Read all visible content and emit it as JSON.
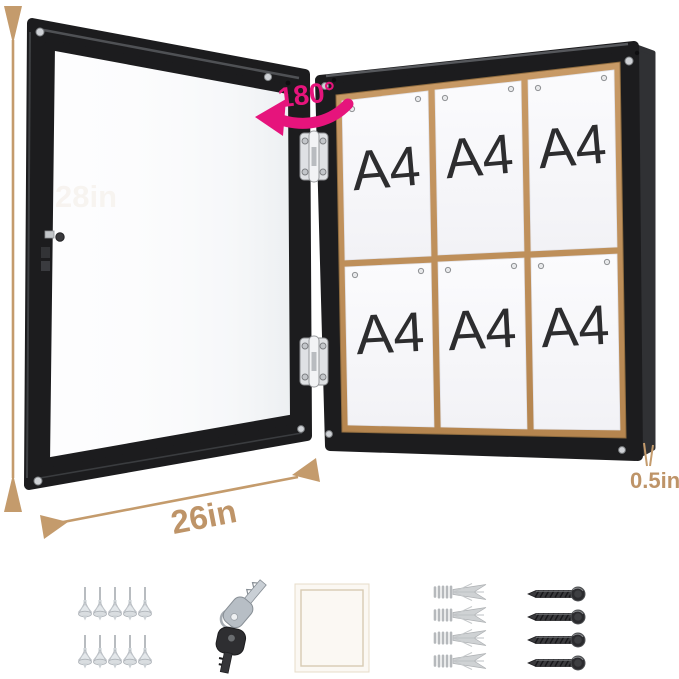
{
  "dimensions": {
    "height": "28in",
    "width": "26in",
    "depth": "0.5in",
    "door_rotation": "180°"
  },
  "board": {
    "rows": 2,
    "cols": 3,
    "papers": [
      {
        "label": "A4"
      },
      {
        "label": "A4"
      },
      {
        "label": "A4"
      },
      {
        "label": "A4"
      },
      {
        "label": "A4"
      },
      {
        "label": "A4"
      }
    ]
  },
  "hardware": {
    "push_pins": {
      "icon": "push-pin-icon",
      "count": 10
    },
    "keys": {
      "icon": "key-icon",
      "count": 2
    },
    "backing_sheet": {
      "icon": "paper-sheet-icon",
      "count": 1
    },
    "wall_anchors": {
      "icon": "wall-anchor-icon",
      "count": 4
    },
    "screws": {
      "icon": "screw-icon",
      "count": 4
    }
  },
  "colors": {
    "dimension_tan": "#BE9468",
    "rotation_pink": "#E6147C",
    "frame_black": "#1c1c1e",
    "cork": "#C2925E",
    "paper_white": "#F7F7FA"
  }
}
